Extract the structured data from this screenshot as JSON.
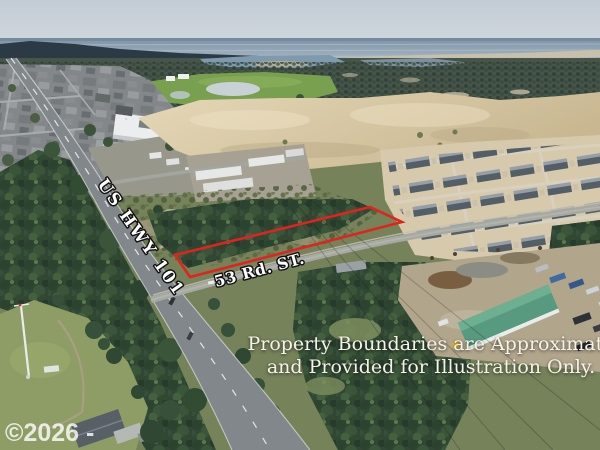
{
  "annotations": {
    "highway_label": "US HWY 101",
    "street_label": "53 Rd. ST.",
    "disclaimer_line1": "Property Boundaries are Approximate",
    "disclaimer_line2": "and Provided for Illustration Only.",
    "watermark": "©2026 - "
  },
  "boundary": {
    "points": "175,255 370,207 402,222 190,277",
    "color": "#e2231d"
  },
  "scene": {
    "description": "Aerial drone photo of a treed vacant parcel outlined in red along US HWY 101 at 53 Rd. ST., with ocean horizon, golf course, sand dunes, new housing development and industrial yard",
    "colors": {
      "sky": "#c6cfd7",
      "ocean": "#8aa0b2",
      "sand_dunes": "#dccfae",
      "forest": "#33492f",
      "grass_field": "#8d9d65",
      "asphalt": "#82878b",
      "boundary_red": "#e2231d",
      "warehouse_roof": "#579a80",
      "disclaimer_text": "#f5f2e8"
    }
  }
}
